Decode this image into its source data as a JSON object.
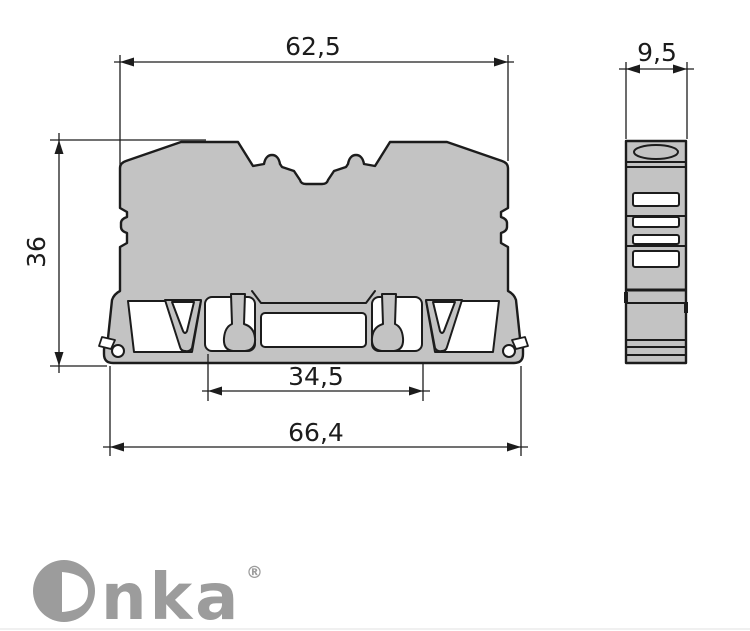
{
  "drawing": {
    "type": "technical-dimension-drawing",
    "views": {
      "count": 2
    },
    "dimensions": {
      "top_width": "62,5",
      "side_width": "9,5",
      "height": "36",
      "rail_slot_width": "34,5",
      "total_width": "66,4"
    },
    "logo": {
      "brand": "Onka",
      "brand_display_tail": "nka",
      "registered_mark": "®"
    },
    "colors": {
      "body_fill": "#c3c3c3",
      "outline": "#1c1c1c",
      "dimension_line": "#1c1c1c",
      "cutout_fill": "#ffffff",
      "logo_gray": "#9c9c9c",
      "background": "#ffffff"
    }
  }
}
